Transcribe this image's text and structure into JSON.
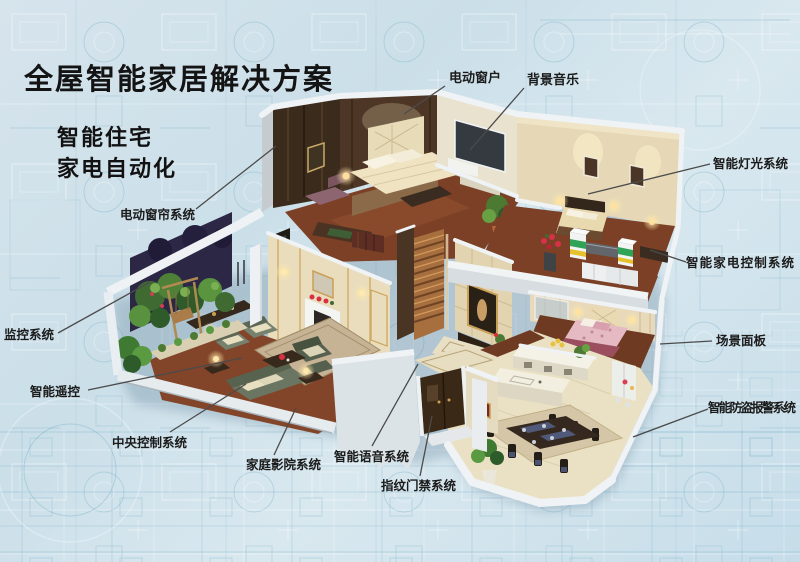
{
  "title": "全屋智能家居解决方案",
  "subtitle": {
    "line1": "智能住宅",
    "line2": "家电自动化"
  },
  "callouts": {
    "electric_window": "电动窗户",
    "background_music": "背景音乐",
    "smart_lighting": "智能灯光系统",
    "appliance_control": "智能家电控制系统",
    "scene_panel": "场景面板",
    "burglar_alarm": "智能防盗报警系统",
    "electric_curtain": "电动窗帘系统",
    "monitoring": "监控系统",
    "smart_remote": "智能遥控",
    "central_control": "中央控制系统",
    "home_theater": "家庭影院系统",
    "voice_system": "智能语音系统",
    "fingerprint_access": "指纹门禁系统"
  },
  "colors": {
    "background": "#cfe1ea",
    "blueprint_line": "#8fbdd0",
    "title_text": "#141414",
    "label_text": "#1b1b1b",
    "leader_line": "#4b4b4b",
    "wall_cream": "#e9ddbd",
    "wood_dark": "#4b3524",
    "floor_wood": "#7b4026",
    "wall_top_white": "#f0f3f5"
  }
}
